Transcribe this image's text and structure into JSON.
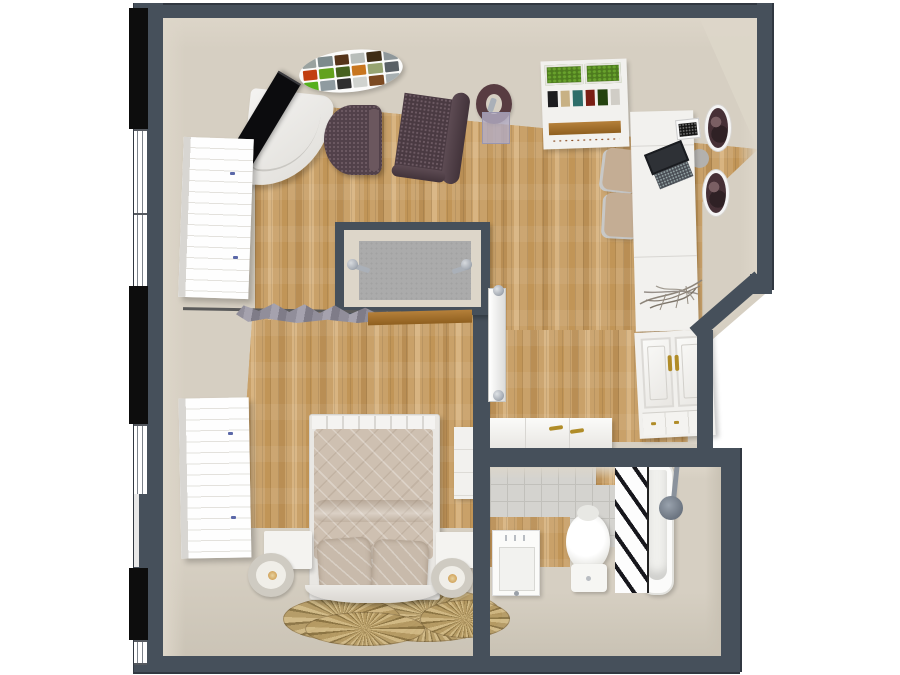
{
  "scene": {
    "name": "3d-floor-plan-top-view",
    "description": "Top-down 3D rendered floor plan of a studio apartment with living area, bedroom area, walk-in shower closet, dressing area and bathroom",
    "view": "top-down dollhouse render",
    "visible_text": []
  },
  "colors": {
    "wall": "#46505b",
    "wallShadow": "#313841",
    "floor": "#d6cfc2",
    "floorFace": "#ddd6c9",
    "floorDark": "#c9c2b4",
    "wood": "#c9a169",
    "woodStripeA": "#b98e54",
    "woodStripeB": "#d8b481",
    "woodStripeC": "#c19557",
    "closetFloor": "#ababab",
    "tile": "#d4d3cf",
    "tileLine": "#c1c0bb",
    "white": "#f2f1ee",
    "chairDark": "#52414a",
    "chairDot": "#6d5a63",
    "armchair": "#4a3a42",
    "lampRing": "#583c41",
    "lavender": "#b4aec6",
    "green": "#4e7b1f",
    "greenLight": "#68a22c",
    "tan": "#c4ad94",
    "chrome": "#aab0b8",
    "chromeDark": "#8a929c",
    "gold": "#b08c28",
    "clothA": "#918e9a",
    "clothB": "#a5a2ae",
    "clothC": "#7f7c88",
    "duvet": "#cec0b1",
    "pillow": "#c8baab",
    "rugA": "#b59a63",
    "rugB": "#8a7342",
    "rugC": "#d2ba85",
    "black": "#0c0c0e",
    "laptop": "#2e3136",
    "laptopKey": "#4a4e55",
    "plate": "#463036",
    "plateSwirl": "#7a5f63",
    "towel": "#17171c",
    "grayStool": "#b3b1ae",
    "windowLine": "#7d838b"
  },
  "left_wall": {
    "segments": [
      {
        "kind": "dark-panel",
        "top": 5,
        "height": 121
      },
      {
        "kind": "window",
        "top": 126,
        "height": 82
      },
      {
        "kind": "window",
        "top": 210,
        "height": 73
      },
      {
        "kind": "dark-panel",
        "top": 283,
        "height": 138
      },
      {
        "kind": "window",
        "top": 421,
        "height": 70
      },
      {
        "kind": "window-narrow",
        "top": 491,
        "height": 73
      },
      {
        "kind": "dark-panel",
        "top": 565,
        "height": 72
      },
      {
        "kind": "window",
        "top": 637,
        "height": 21
      }
    ]
  },
  "oval_shelf": {
    "cells": [
      "#9aa29f",
      "#7d8a8c",
      "#55341a",
      "#b9beba",
      "#3f2d16",
      "#8e979a",
      "#c23f10",
      "#63a21d",
      "#46611f",
      "#c8761f",
      "#97a471",
      "#5a6166",
      "#55b01e",
      "#8f9ba0",
      "#2f2f2f",
      "#d0d3cf",
      "#7c4a22",
      "#a8b0b2"
    ]
  },
  "plant_shelf": {
    "books": [
      "#1c1c1e",
      "#c8b184",
      "#2e6e6a",
      "#7a1f14",
      "#24430f",
      "#d0cdc6"
    ]
  },
  "rooms": [
    {
      "name": "living-area",
      "floor": "wood-with-carpet-border"
    },
    {
      "name": "bedroom-area",
      "floor": "wood-with-carpet-border"
    },
    {
      "name": "shower-closet",
      "floor": "gray"
    },
    {
      "name": "dressing-area",
      "floor": "wood"
    },
    {
      "name": "bathroom",
      "floor": "tile-wood-carpet"
    }
  ],
  "furniture": [
    {
      "name": "corner-tv-stand",
      "room": "living-area"
    },
    {
      "name": "flat-tv",
      "room": "living-area"
    },
    {
      "name": "oval-wall-shelf",
      "room": "living-area"
    },
    {
      "name": "tub-chair",
      "room": "living-area"
    },
    {
      "name": "armchair",
      "room": "living-area"
    },
    {
      "name": "floor-lamp",
      "room": "living-area"
    },
    {
      "name": "plant-shelf",
      "room": "living-area"
    },
    {
      "name": "desk",
      "room": "living-area"
    },
    {
      "name": "laptop",
      "room": "living-area"
    },
    {
      "name": "desk-radio",
      "room": "living-area"
    },
    {
      "name": "desk-chair",
      "room": "living-area"
    },
    {
      "name": "desk-chair",
      "room": "living-area"
    },
    {
      "name": "wall-plate",
      "room": "living-area"
    },
    {
      "name": "wall-plate",
      "room": "living-area"
    },
    {
      "name": "twig-decoration",
      "room": "living-area"
    },
    {
      "name": "coat-rack-with-clothes",
      "room": "living-area"
    },
    {
      "name": "wall-board",
      "room": "living-area"
    },
    {
      "name": "radiator",
      "room": "dressing-area"
    },
    {
      "name": "wardrobe",
      "room": "living-area"
    },
    {
      "name": "wardrobe",
      "room": "bedroom-area"
    },
    {
      "name": "double-bed",
      "room": "bedroom-area"
    },
    {
      "name": "nightstand",
      "room": "bedroom-area"
    },
    {
      "name": "nightstand",
      "room": "bedroom-area"
    },
    {
      "name": "table-lamp",
      "room": "bedroom-area"
    },
    {
      "name": "table-lamp",
      "room": "bedroom-area"
    },
    {
      "name": "bedside-cabinet",
      "room": "bedroom-area"
    },
    {
      "name": "fan-rug",
      "room": "bedroom-area"
    },
    {
      "name": "dresser",
      "room": "dressing-area"
    },
    {
      "name": "paneled-wardrobe",
      "room": "dressing-area"
    },
    {
      "name": "sink",
      "room": "bathroom"
    },
    {
      "name": "toilet",
      "room": "bathroom"
    },
    {
      "name": "towel-ladder",
      "room": "bathroom"
    },
    {
      "name": "bathtub",
      "room": "bathroom"
    },
    {
      "name": "shower-head",
      "room": "bathroom"
    },
    {
      "name": "shower-hooks",
      "room": "shower-closet"
    }
  ]
}
